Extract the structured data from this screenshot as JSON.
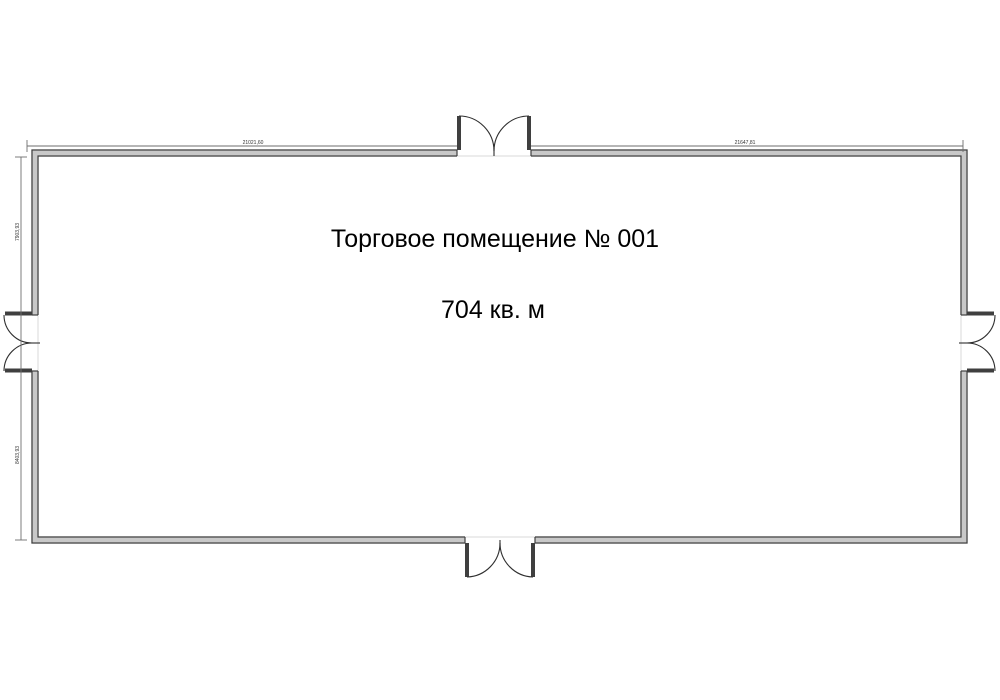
{
  "plan": {
    "title": "Торговое помещение № 001",
    "area": "704 кв. м",
    "dimensions": {
      "top_left": "21021,60",
      "top_right": "21647,81",
      "left_upper": "7903,93",
      "left_lower": "8403,93"
    },
    "colors": {
      "wall_edge": "#3f3f3f",
      "wall_fill": "#c8c8c8",
      "dim_line": "#6e6e6e",
      "text_main": "#000000",
      "text_dim": "#333333"
    }
  }
}
